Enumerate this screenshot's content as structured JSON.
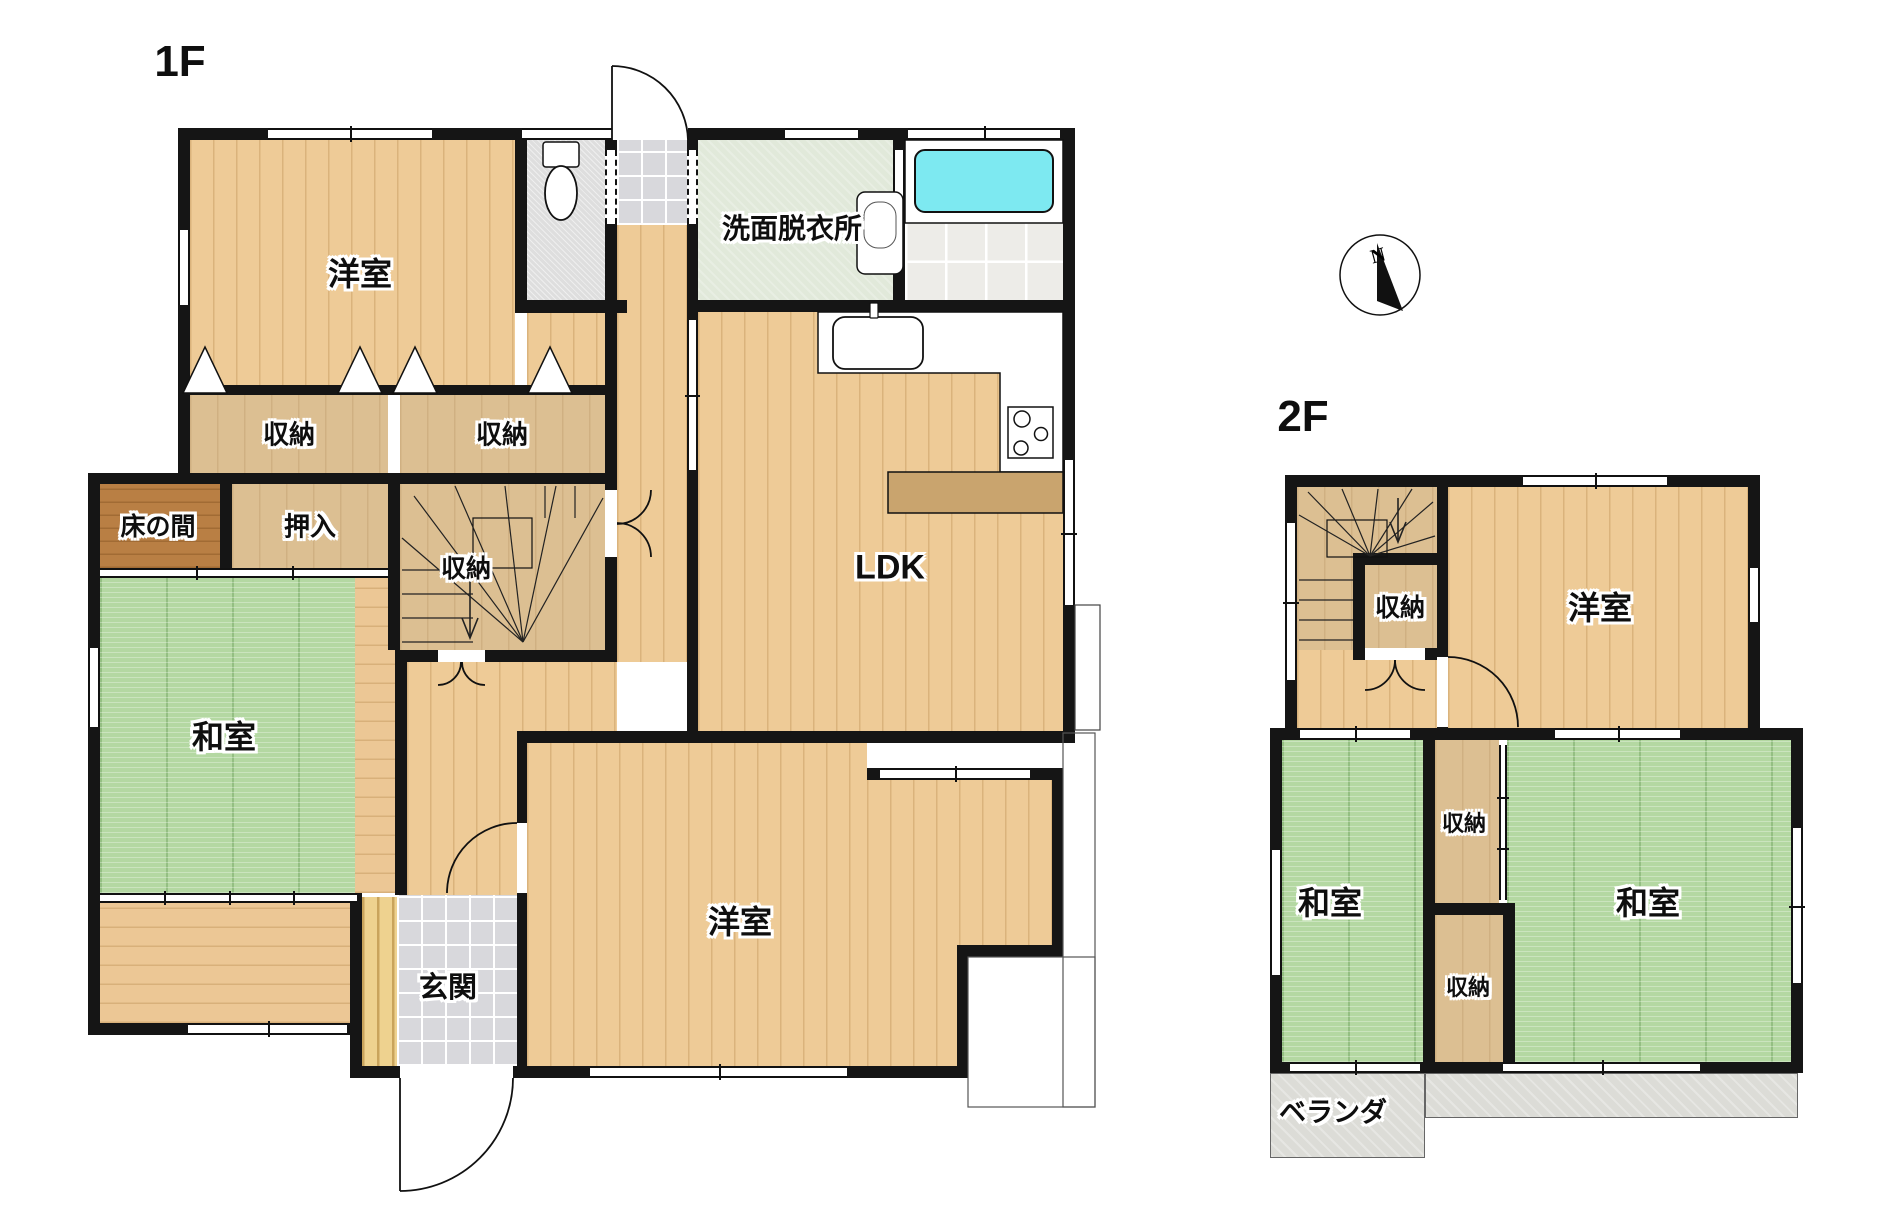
{
  "titles": {
    "floor1": "1F",
    "floor2": "2F"
  },
  "compass": {
    "label": "N",
    "cx": 1380,
    "cy": 275,
    "r": 40,
    "needle": "1377,243 1403,311 1377,301",
    "label_x": 1378,
    "label_y": 262
  },
  "colors": {
    "wall": "#151515",
    "tatami": "#b4d8a2",
    "wood": "#eecb97",
    "tub": "#7de9f1",
    "counter": "#c9a46e",
    "balcony": "#dcdcd7",
    "wash_floor": "#e1e9da"
  },
  "floors": [
    {
      "name": "1f-western-room-north-floor",
      "cls": "wood-v",
      "x": 190,
      "y": 140,
      "w": 325,
      "h": 245
    },
    {
      "name": "1f-landing-patch-floor",
      "cls": "wood-v",
      "x": 527,
      "y": 313,
      "w": 78,
      "h": 82
    },
    {
      "name": "1f-toilet-floor",
      "cls": "speckle",
      "x": 527,
      "y": 140,
      "w": 78,
      "h": 160
    },
    {
      "name": "1f-service-entry-tile",
      "cls": "marble",
      "x": 617,
      "y": 140,
      "w": 70,
      "h": 85
    },
    {
      "name": "1f-washroom-floor",
      "cls": "wash",
      "x": 698,
      "y": 140,
      "w": 195,
      "h": 160
    },
    {
      "name": "1f-bathroom-floor",
      "cls": "bathtile",
      "x": 905,
      "y": 223,
      "w": 158,
      "h": 80
    },
    {
      "name": "1f-ldk-floor",
      "cls": "wood-v",
      "x": 698,
      "y": 312,
      "w": 365,
      "h": 419
    },
    {
      "name": "1f-storage-a-floor",
      "cls": "tan",
      "x": 190,
      "y": 395,
      "w": 198,
      "h": 78
    },
    {
      "name": "1f-storage-b-floor",
      "cls": "tan",
      "x": 400,
      "y": 395,
      "w": 205,
      "h": 78
    },
    {
      "name": "1f-tokonoma-floor",
      "cls": "dark",
      "x": 100,
      "y": 484,
      "w": 120,
      "h": 84
    },
    {
      "name": "1f-oshiire-floor",
      "cls": "tan",
      "x": 232,
      "y": 484,
      "w": 156,
      "h": 84
    },
    {
      "name": "1f-stairs-floor",
      "cls": "tan",
      "x": 400,
      "y": 484,
      "w": 205,
      "h": 166
    },
    {
      "name": "1f-japanese-room-tatami",
      "cls": "tatami",
      "x": 100,
      "y": 578,
      "w": 257,
      "h": 315
    },
    {
      "name": "1f-engawa-east-strip",
      "cls": "wood-h",
      "x": 355,
      "y": 578,
      "w": 40,
      "h": 315
    },
    {
      "name": "1f-engawa-south-corridor",
      "cls": "wood-h",
      "x": 100,
      "y": 903,
      "w": 250,
      "h": 120
    },
    {
      "name": "1f-hallway-floor",
      "cls": "wood-v",
      "x": 617,
      "y": 225,
      "w": 70,
      "h": 437
    },
    {
      "name": "1f-hall-mid-floor",
      "cls": "wood-v",
      "x": 407,
      "y": 662,
      "w": 210,
      "h": 69
    },
    {
      "name": "1f-hall-south-floor",
      "cls": "wood-v",
      "x": 407,
      "y": 731,
      "w": 110,
      "h": 164
    },
    {
      "name": "1f-genkan-step-slats",
      "cls": "slats",
      "x": 362,
      "y": 897,
      "w": 35,
      "h": 170
    },
    {
      "name": "1f-genkan-tile",
      "cls": "marble",
      "x": 397,
      "y": 895,
      "w": 120,
      "h": 171
    },
    {
      "name": "1f-western-room-south-floor",
      "cls": "wood-v",
      "x": 527,
      "y": 743,
      "w": 340,
      "h": 323
    },
    {
      "name": "1f-western-room-south-floor-e1",
      "cls": "wood-v",
      "x": 867,
      "y": 780,
      "w": 185,
      "h": 166
    },
    {
      "name": "1f-western-room-south-floor-e2",
      "cls": "wood-v",
      "x": 867,
      "y": 946,
      "w": 90,
      "h": 120
    },
    {
      "name": "2f-stairs-floor",
      "cls": "tan",
      "x": 1297,
      "y": 487,
      "w": 140,
      "h": 163
    },
    {
      "name": "2f-hall-floor",
      "cls": "wood-v",
      "x": 1297,
      "y": 650,
      "w": 140,
      "h": 78
    },
    {
      "name": "2f-western-room-floor",
      "cls": "wood-v",
      "x": 1448,
      "y": 487,
      "w": 300,
      "h": 241
    },
    {
      "name": "2f-japanese-room-west-tatami",
      "cls": "tatami",
      "x": 1282,
      "y": 740,
      "w": 141,
      "h": 322
    },
    {
      "name": "2f-storage-upper-floor",
      "cls": "tan",
      "x": 1435,
      "y": 740,
      "w": 64,
      "h": 163
    },
    {
      "name": "2f-storage-lower-floor",
      "cls": "tan",
      "x": 1435,
      "y": 915,
      "w": 68,
      "h": 147
    },
    {
      "name": "2f-japanese-room-east-tatami",
      "cls": "tatami",
      "x": 1507,
      "y": 740,
      "w": 284,
      "h": 322
    },
    {
      "name": "2f-balcony-west",
      "cls": "balc",
      "x": 1270,
      "y": 1073,
      "w": 155,
      "h": 85
    },
    {
      "name": "2f-balcony-east",
      "cls": "balc",
      "x": 1425,
      "y": 1073,
      "w": 373,
      "h": 45
    }
  ],
  "walls": [
    [
      178,
      128,
      897,
      12
    ],
    [
      178,
      128,
      12,
      356
    ],
    [
      88,
      473,
      12,
      562
    ],
    [
      178,
      385,
      439,
      10
    ],
    [
      88,
      473,
      529,
      11
    ],
    [
      515,
      140,
      12,
      173
    ],
    [
      515,
      300,
      112,
      13
    ],
    [
      605,
      140,
      12,
      522
    ],
    [
      687,
      140,
      11,
      603
    ],
    [
      893,
      140,
      12,
      172
    ],
    [
      688,
      300,
      387,
      12
    ],
    [
      1063,
      128,
      12,
      615
    ],
    [
      517,
      731,
      558,
      12
    ],
    [
      517,
      731,
      10,
      347
    ],
    [
      867,
      768,
      185,
      12
    ],
    [
      1052,
      768,
      11,
      189
    ],
    [
      957,
      945,
      106,
      12
    ],
    [
      957,
      945,
      11,
      133
    ],
    [
      362,
      1066,
      606,
      12
    ],
    [
      88,
      1023,
      274,
      12
    ],
    [
      350,
      893,
      12,
      185
    ],
    [
      220,
      484,
      12,
      86
    ],
    [
      388,
      484,
      12,
      166
    ],
    [
      400,
      650,
      217,
      12
    ],
    [
      395,
      650,
      12,
      245
    ],
    [
      1285,
      475,
      475,
      12
    ],
    [
      1285,
      475,
      12,
      265
    ],
    [
      1748,
      475,
      12,
      265
    ],
    [
      1270,
      728,
      533,
      12
    ],
    [
      1270,
      728,
      12,
      345
    ],
    [
      1791,
      728,
      12,
      345
    ],
    [
      1270,
      1062,
      533,
      11
    ],
    [
      1437,
      487,
      11,
      241
    ],
    [
      1353,
      553,
      84,
      12
    ],
    [
      1353,
      553,
      12,
      107
    ],
    [
      1353,
      648,
      84,
      12
    ],
    [
      1423,
      740,
      12,
      322
    ],
    [
      1423,
      903,
      92,
      12
    ],
    [
      1503,
      915,
      12,
      147
    ]
  ],
  "windows": [
    {
      "x": 268,
      "y": 128,
      "w": 164,
      "h": 12,
      "o": "h",
      "t": 1
    },
    {
      "x": 522,
      "y": 128,
      "w": 90,
      "h": 12,
      "o": "h",
      "t": 0
    },
    {
      "x": 785,
      "y": 128,
      "w": 73,
      "h": 12,
      "o": "h",
      "t": 0
    },
    {
      "x": 908,
      "y": 128,
      "w": 152,
      "h": 12,
      "o": "h",
      "t": 1
    },
    {
      "x": 178,
      "y": 230,
      "w": 12,
      "h": 75,
      "o": "v",
      "t": 0
    },
    {
      "x": 88,
      "y": 648,
      "w": 12,
      "h": 79,
      "o": "v",
      "t": 0
    },
    {
      "x": 1063,
      "y": 460,
      "w": 12,
      "h": 145,
      "o": "v",
      "t": 1
    },
    {
      "x": 880,
      "y": 768,
      "w": 150,
      "h": 12,
      "o": "h",
      "t": 1
    },
    {
      "x": 590,
      "y": 1066,
      "w": 257,
      "h": 12,
      "o": "h",
      "t": 1
    },
    {
      "x": 188,
      "y": 1023,
      "w": 159,
      "h": 12,
      "o": "h",
      "t": 1
    },
    {
      "x": 100,
      "y": 893,
      "w": 257,
      "h": 10,
      "o": "h",
      "t": 3
    },
    {
      "x": 100,
      "y": 568,
      "w": 288,
      "h": 10,
      "o": "h",
      "t": 2
    },
    {
      "x": 612,
      "y": 128,
      "w": 76,
      "h": 12,
      "o": "o"
    },
    {
      "x": 605,
      "y": 490,
      "w": 12,
      "h": 67,
      "o": "o"
    },
    {
      "x": 517,
      "y": 823,
      "w": 10,
      "h": 70,
      "o": "o"
    },
    {
      "x": 400,
      "y": 1066,
      "w": 113,
      "h": 12,
      "o": "o"
    },
    {
      "x": 438,
      "y": 650,
      "w": 47,
      "h": 12,
      "o": "o"
    },
    {
      "x": 605,
      "y": 150,
      "w": 12,
      "h": 74,
      "o": "v",
      "d": 1
    },
    {
      "x": 687,
      "y": 150,
      "w": 11,
      "h": 74,
      "o": "v",
      "d": 1
    },
    {
      "x": 893,
      "y": 150,
      "w": 12,
      "h": 73,
      "o": "v",
      "t": 0
    },
    {
      "x": 687,
      "y": 320,
      "w": 11,
      "h": 150,
      "o": "v",
      "t": 1
    },
    {
      "x": 1523,
      "y": 475,
      "w": 144,
      "h": 12,
      "o": "h",
      "t": 1
    },
    {
      "x": 1285,
      "y": 523,
      "w": 12,
      "h": 157,
      "o": "v",
      "t": 1
    },
    {
      "x": 1748,
      "y": 568,
      "w": 12,
      "h": 54,
      "o": "v",
      "t": 0
    },
    {
      "x": 1300,
      "y": 728,
      "w": 110,
      "h": 12,
      "o": "h",
      "t": 1
    },
    {
      "x": 1555,
      "y": 728,
      "w": 125,
      "h": 12,
      "o": "h",
      "t": 1
    },
    {
      "x": 1270,
      "y": 850,
      "w": 12,
      "h": 125,
      "o": "v",
      "t": 0
    },
    {
      "x": 1791,
      "y": 828,
      "w": 12,
      "h": 155,
      "o": "v",
      "t": 1
    },
    {
      "x": 1290,
      "y": 1062,
      "w": 130,
      "h": 11,
      "o": "h",
      "t": 1
    },
    {
      "x": 1503,
      "y": 1062,
      "w": 197,
      "h": 11,
      "o": "h",
      "t": 1
    },
    {
      "x": 1499,
      "y": 745,
      "w": 8,
      "h": 155,
      "o": "v",
      "t": 2
    },
    {
      "x": 1437,
      "y": 657,
      "w": 11,
      "h": 70,
      "o": "o"
    },
    {
      "x": 1365,
      "y": 648,
      "w": 60,
      "h": 12,
      "o": "o"
    }
  ],
  "labels": [
    {
      "text": "1F",
      "x": 180,
      "y": 62,
      "fs": 44
    },
    {
      "text": "洋室",
      "x": 360,
      "y": 272,
      "fs": 32
    },
    {
      "text": "収納",
      "x": 289,
      "y": 433,
      "fs": 26
    },
    {
      "text": "収納",
      "x": 502,
      "y": 433,
      "fs": 26
    },
    {
      "text": "床の間",
      "x": 158,
      "y": 525,
      "fs": 25
    },
    {
      "text": "押入",
      "x": 310,
      "y": 525,
      "fs": 26
    },
    {
      "text": "収納",
      "x": 466,
      "y": 567,
      "fs": 25
    },
    {
      "text": "和室",
      "x": 224,
      "y": 735,
      "fs": 32
    },
    {
      "text": "LDK",
      "x": 890,
      "y": 568,
      "fs": 34
    },
    {
      "text": "洗面脱衣所",
      "x": 792,
      "y": 227,
      "fs": 28
    },
    {
      "text": "玄関",
      "x": 448,
      "y": 985,
      "fs": 29
    },
    {
      "text": "洋室",
      "x": 740,
      "y": 920,
      "fs": 32
    },
    {
      "text": "2F",
      "x": 1303,
      "y": 417,
      "fs": 44
    },
    {
      "text": "収納",
      "x": 1400,
      "y": 606,
      "fs": 25
    },
    {
      "text": "洋室",
      "x": 1600,
      "y": 606,
      "fs": 32
    },
    {
      "text": "和室",
      "x": 1330,
      "y": 901,
      "fs": 32
    },
    {
      "text": "収納",
      "x": 1464,
      "y": 822,
      "fs": 22
    },
    {
      "text": "収納",
      "x": 1468,
      "y": 986,
      "fs": 22
    },
    {
      "text": "和室",
      "x": 1648,
      "y": 901,
      "fs": 32
    },
    {
      "text": "ベランダ",
      "x": 1333,
      "y": 1110,
      "fs": 27
    }
  ],
  "svg": {
    "rects": [
      {
        "name": "bathtub-deck",
        "x": 905,
        "y": 140,
        "w": 158,
        "h": 83,
        "f": "#ffffff",
        "s": "#111",
        "sw": 1.5,
        "rx": 0
      },
      {
        "name": "bathtub",
        "x": 915,
        "y": 150,
        "w": 138,
        "h": 62,
        "f": "#7de9f1",
        "s": "#111",
        "sw": 2,
        "rx": 10
      },
      {
        "name": "kitchen-counter-bar",
        "x": 888,
        "y": 472,
        "w": 175,
        "h": 41,
        "f": "#c9a46e",
        "s": "#111",
        "sw": 1.5,
        "rx": 0
      },
      {
        "name": "kitchen-sink",
        "x": 833,
        "y": 317,
        "w": 90,
        "h": 52,
        "f": "#ffffff",
        "s": "#111",
        "sw": 1.8,
        "rx": 12
      },
      {
        "name": "kitchen-faucet",
        "x": 870,
        "y": 303,
        "w": 8,
        "h": 15,
        "f": "#ffffff",
        "s": "#111",
        "sw": 1.2,
        "rx": 1
      },
      {
        "name": "stove",
        "x": 1008,
        "y": 407,
        "w": 45,
        "h": 51,
        "f": "#ffffff",
        "s": "#111",
        "sw": 1.5,
        "rx": 0
      },
      {
        "name": "toilet-tank",
        "x": 543,
        "y": 142,
        "w": 36,
        "h": 25,
        "f": "#ffffff",
        "s": "#111",
        "sw": 1.5,
        "rx": 3
      },
      {
        "name": "wash-basin",
        "x": 857,
        "y": 192,
        "w": 46,
        "h": 82,
        "f": "#ffffff",
        "s": "#111",
        "sw": 1.5,
        "rx": 8
      },
      {
        "name": "wash-basin-bowl",
        "x": 864,
        "y": 202,
        "w": 32,
        "h": 46,
        "f": "none",
        "s": "#555",
        "sw": 1,
        "rx": 14
      },
      {
        "name": "stair-post-1f",
        "x": 473,
        "y": 518,
        "w": 59,
        "h": 50,
        "f": "none",
        "s": "#111",
        "sw": 1.2,
        "rx": 0
      },
      {
        "name": "stair-post-2f",
        "x": 1327,
        "y": 520,
        "w": 60,
        "h": 37,
        "f": "none",
        "s": "#111",
        "sw": 1.2,
        "rx": 0
      },
      {
        "name": "ldk-bay-window",
        "x": 1075,
        "y": 605,
        "w": 25,
        "h": 125,
        "f": "#ffffff",
        "s": "#444",
        "sw": 1.2,
        "rx": 0
      },
      {
        "name": "porch-outline-east",
        "x": 1063,
        "y": 733,
        "w": 32,
        "h": 374,
        "f": "none",
        "s": "#555",
        "sw": 1.2,
        "rx": 0
      },
      {
        "name": "porch-outline-south",
        "x": 968,
        "y": 957,
        "w": 127,
        "h": 150,
        "f": "none",
        "s": "#555",
        "sw": 1.2,
        "rx": 0
      }
    ],
    "kitchen_path": {
      "name": "kitchen-counter-zone",
      "d": "M818,312 H1063 V472 H1000 V373 H818 Z",
      "f": "#ffffff",
      "s": "#111",
      "sw": 1.5
    },
    "circles": [
      {
        "name": "stove-burner",
        "cx": 1022,
        "cy": 419,
        "r": 8
      },
      {
        "name": "stove-burner",
        "cx": 1041,
        "cy": 434,
        "r": 6.5
      },
      {
        "name": "stove-burner",
        "cx": 1021,
        "cy": 448,
        "r": 7
      }
    ],
    "ellipses": [
      {
        "name": "toilet-bowl",
        "cx": 561,
        "cy": 193,
        "rx": 16,
        "ry": 27
      }
    ],
    "polygons": [
      {
        "name": "closet-door-mark",
        "pts": "183,393 227,393 205,347"
      },
      {
        "name": "closet-door-mark",
        "pts": "338,393 382,393 360,347"
      },
      {
        "name": "closet-door-mark",
        "pts": "393,393 437,393 415,347"
      },
      {
        "name": "closet-door-mark",
        "pts": "528,393 572,393 550,347"
      }
    ],
    "arcs": [
      "M612,66 A76,76 0 0 1 688,140",
      "M612,140 L612,66",
      "M400,1191 A113,113 0 0 0 513,1078",
      "M400,1078 L400,1191",
      "M651,490 A34,34 0 0 1 617,524",
      "M651,557 A34,34 0 0 0 617,523",
      "M438,685 A23,23 0 0 0 461,662",
      "M485,685 A23,23 0 0 1 462,662",
      "M447,893 A70,70 0 0 1 517,823",
      "M1518,727 A70,70 0 0 0 1448,657",
      "M1365,690 A30,30 0 0 0 1395,660",
      "M1425,690 A30,30 0 0 1 1395,660"
    ],
    "stair_lines": [
      "M523,642 L402,538",
      "M523,642 L414,496",
      "M523,642 L455,486",
      "M523,642 L505,486",
      "M523,642 L556,486",
      "M523,642 L603,498",
      "M402,570 L473,570",
      "M402,594 L473,594",
      "M402,618 L473,618",
      "M402,642 L473,642",
      "M545,486 L545,518",
      "M575,486 L575,518",
      "M1370,556 L1299,515",
      "M1370,556 L1308,492",
      "M1370,556 L1342,489",
      "M1370,556 L1378,489",
      "M1370,556 L1412,489",
      "M1370,556 L1433,502",
      "M1370,556 L1435,536",
      "M1299,580 L1353,580",
      "M1299,600 L1353,600",
      "M1299,620 L1353,620",
      "M1299,640 L1353,640"
    ],
    "arrows": [
      "M470,578 L470,636",
      "M462,618 L470,638 L478,618",
      "M1398,498 L1398,540",
      "M1390,522 L1398,542 L1406,522"
    ]
  }
}
